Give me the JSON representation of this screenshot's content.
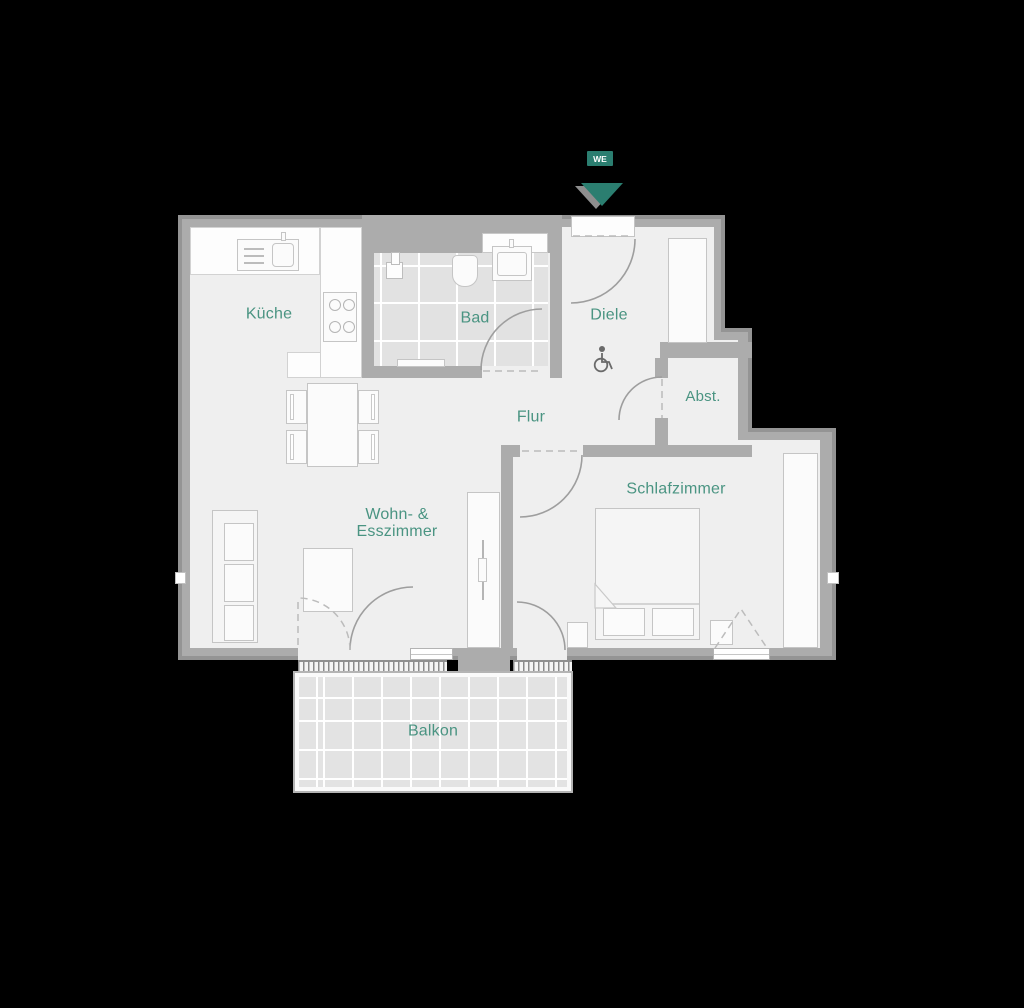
{
  "entrance": {
    "badge": "WE",
    "arrow_icon": "entrance-arrow-down"
  },
  "rooms": {
    "kitchen": "Küche",
    "bath": "Bad",
    "entry_hall": "Diele",
    "storage": "Abst.",
    "corridor": "Flur",
    "living_line1": "Wohn- &",
    "living_line2": "Esszimmer",
    "bedroom": "Schlafzimmer",
    "balcony": "Balkon"
  },
  "icons": {
    "accessibility": "wheelchair-icon"
  },
  "colors": {
    "background": "#000000",
    "wall": "#acacac",
    "wall_edge": "#949494",
    "floor": "#efefef",
    "tile": "#e2e2e2",
    "label": "#4a9482",
    "accent": "#2b7e70"
  }
}
